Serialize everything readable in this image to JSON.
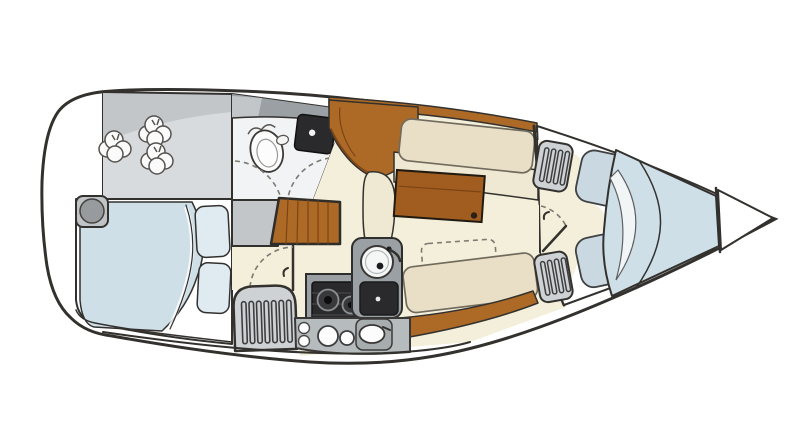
{
  "meta": {
    "title": "Sailboat interior layout floor plan",
    "view": "top-down",
    "bow_direction": "right",
    "text_on_image": ""
  },
  "colors": {
    "line": "#33312e",
    "dash_line": "#7c7a72",
    "hull_fill": "#ffffff",
    "locker_gray": "#d8dbdd",
    "locker_gray_dark": "#c2c6c9",
    "head_floor": "#f2f3f4",
    "floor_cream": "#f4efda",
    "upholstery_cream": "#e9dfc6",
    "seat_cream": "#efe8d2",
    "wood": "#ad6a26",
    "wood_dark": "#7c4414",
    "table_wood": "#a05d1f",
    "berth_blue": "#cfdfe8",
    "pillow_blue": "#dfeaf1",
    "cushion_blue": "#c9d8e1",
    "fixture_gray": "#9aa0a3",
    "counter_gray": "#b6bbbe",
    "louver_gray": "#ced2d4",
    "dark_appliance": "#2a2a2c"
  },
  "rooms": [
    {
      "id": "stern-locker",
      "label": "Stern storage locker with fenders"
    },
    {
      "id": "aft-cabin",
      "label": "Aft double cabin"
    },
    {
      "id": "head",
      "label": "Head (bathroom)"
    },
    {
      "id": "saloon",
      "label": "Saloon"
    },
    {
      "id": "galley",
      "label": "Galley"
    },
    {
      "id": "forward-cabin",
      "label": "Forward V-berth cabin"
    },
    {
      "id": "forepeak",
      "label": "Anchor locker / forepeak"
    }
  ],
  "fixtures": {
    "fenders": "Three fenders in stern locker",
    "aft_berth": "Aft double berth with duvet",
    "pillows": "Two pillows",
    "porthole": "Aft cabin hatch",
    "toilet": "Marine toilet",
    "head_sink": "Head washbasin with tap",
    "steps": "Companionway steps",
    "aft_door": "Aft cabin door (swing shown dashed)",
    "engine_louver": "Louvered engine-compartment front",
    "stove": "Two-burner stove with oven",
    "round_sink": "Round galley sink with tap",
    "icebox": "Icebox / second sink",
    "counter": "Hull-side galley counter with burners and oval sink",
    "table": "Saloon dining table",
    "settee_sb": "Straight settee (cabin-side)",
    "settee_port": "Straight settee (hull-side)",
    "leaf_outline": "Folded table leaf outline (dashed)",
    "lockers_fwd": "Louvered lockers in forward cabin",
    "fwd_cushions": "Two seat cushions",
    "v_berth": "V-berth with folded blanket",
    "fwd_door": "Forward cabin door (swing shown dashed)"
  }
}
